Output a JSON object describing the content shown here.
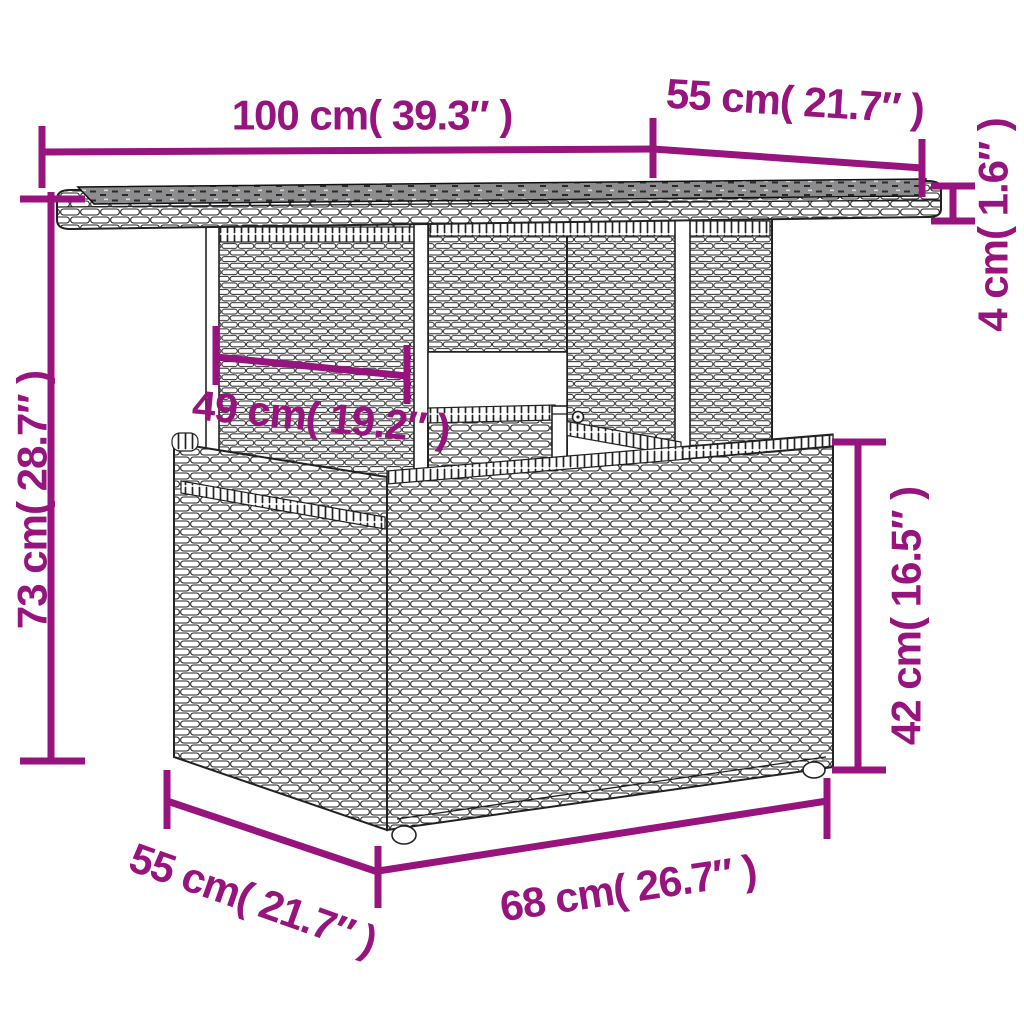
{
  "diagram": {
    "type": "product-dimension-diagram",
    "accent_color": "#97137e",
    "outline_color": "#222222",
    "glass_color": "#8d8d8f",
    "background_color": "#ffffff",
    "dimensions": {
      "tabletop_width": {
        "label": "100 cm( 39.3″ )"
      },
      "tabletop_depth": {
        "label": "55 cm( 21.7″ )"
      },
      "tabletop_thickness": {
        "label": "4 cm( 1.6″ )"
      },
      "overall_height": {
        "label": "73 cm( 28.7″ )"
      },
      "pedestal_width": {
        "label": "49 cm( 19.2″ )"
      },
      "base_height": {
        "label": "42 cm( 16.5″ )"
      },
      "base_depth": {
        "label": "55 cm( 21.7″ )"
      },
      "base_width": {
        "label": "68 cm( 26.7″ )"
      }
    }
  }
}
